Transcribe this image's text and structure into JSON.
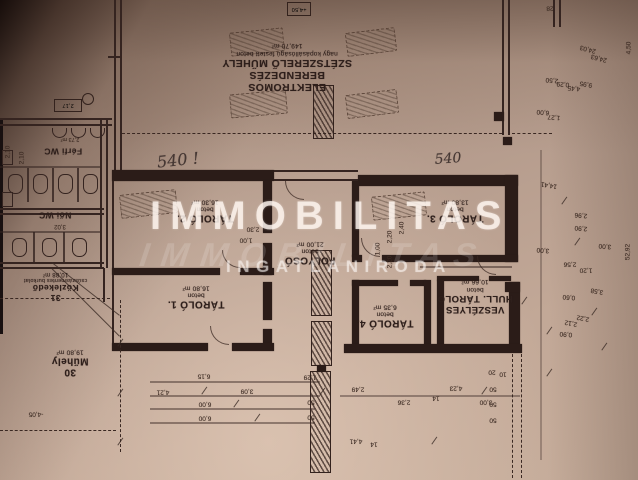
{
  "watermark": {
    "line1": "IMMOBILITAS",
    "line2": "IMMOBILITAS",
    "line3": "INGATLANIRODA"
  },
  "rooms": [
    {
      "name": "ELEKTROMOS BERENDEZÉS",
      "name2": "SZÉTSZERELŐ MŰHELY",
      "material": "nagy kopásállóságú festett beton",
      "area": "149,70 m²"
    },
    {
      "name": "TÁROLÓ 2.",
      "material": "beton",
      "area": "16,30 m²"
    },
    {
      "name": "TÁROLÓ 3.",
      "material": "beton",
      "area": "13,80 m²"
    },
    {
      "name": "FOLYOSÓ",
      "material": "beton",
      "area": "21,00 m²"
    },
    {
      "name": "TÁROLÓ 1.",
      "material": "beton",
      "area": "16,80 m²"
    },
    {
      "name": "TÁROLÓ 4.",
      "material": "beton",
      "area": "6,35 m²"
    },
    {
      "name": "VESZÉLYES",
      "name2": "HULL. TÁROLÓ",
      "material": "beton",
      "area": "10,66 m²"
    },
    {
      "name": "Férfi WC"
    },
    {
      "name": "Női WC"
    },
    {
      "num": "31",
      "name": "Közlekedő",
      "material": "csúszásmentes burkolat",
      "area": "10,88 m²"
    },
    {
      "num": "30",
      "name": "Műhely",
      "area": "19,80 m²"
    }
  ],
  "markers": {
    "level_box": "+4,50",
    "section_box": "2,17",
    "small_mark": "8,8"
  },
  "handwritten": [
    {
      "t": "540 !",
      "x": 178,
      "y": 160,
      "r": -6,
      "fs": 16
    },
    {
      "t": "540",
      "x": 448,
      "y": 159,
      "r": -4,
      "fs": 14
    }
  ],
  "dimensions": [
    {
      "t": "6,15",
      "x": 204,
      "y": 376
    },
    {
      "t": "4,21",
      "x": 163,
      "y": 392
    },
    {
      "t": "3,09",
      "x": 247,
      "y": 391
    },
    {
      "t": "6,00",
      "x": 205,
      "y": 404
    },
    {
      "t": "6,00",
      "x": 205,
      "y": 418
    },
    {
      "t": "1,29",
      "x": 310,
      "y": 377
    },
    {
      "t": "50",
      "x": 311,
      "y": 402
    },
    {
      "t": "50",
      "x": 311,
      "y": 417
    },
    {
      "t": "2,49",
      "x": 358,
      "y": 389
    },
    {
      "t": "2,36",
      "x": 404,
      "y": 402
    },
    {
      "t": "14",
      "x": 436,
      "y": 398
    },
    {
      "t": "3,00",
      "x": 486,
      "y": 402
    },
    {
      "t": "4,23",
      "x": 456,
      "y": 388
    },
    {
      "t": "4,41",
      "x": 356,
      "y": 441
    },
    {
      "t": "14",
      "x": 374,
      "y": 444
    },
    {
      "t": "-4,05",
      "x": 36,
      "y": 414
    },
    {
      "t": "2,30",
      "x": 253,
      "y": 229
    },
    {
      "t": "1,00",
      "x": 246,
      "y": 240
    },
    {
      "t": "2,20",
      "x": 390,
      "y": 237,
      "r": 270
    },
    {
      "t": "2,20",
      "x": 390,
      "y": 262,
      "r": 270
    },
    {
      "t": "1,00",
      "x": 378,
      "y": 249,
      "r": 270
    },
    {
      "t": "2,40",
      "x": 402,
      "y": 228,
      "r": 270
    },
    {
      "t": "2,10",
      "x": 8,
      "y": 152,
      "r": 270
    },
    {
      "t": "2,10",
      "x": 22,
      "y": 158,
      "r": 270
    },
    {
      "t": "2,73 m²",
      "x": 70,
      "y": 139,
      "fs": 5.5
    },
    {
      "t": "3,02",
      "x": 60,
      "y": 226,
      "fs": 6
    },
    {
      "t": "2,56",
      "x": 570,
      "y": 264
    },
    {
      "t": "1,20",
      "x": 586,
      "y": 270
    },
    {
      "t": "24,03",
      "x": 588,
      "y": 49,
      "r": 195
    },
    {
      "t": "24,63",
      "x": 599,
      "y": 58,
      "r": 195
    },
    {
      "t": "2,50",
      "x": 552,
      "y": 80,
      "r": 185
    },
    {
      "t": "0,29",
      "x": 563,
      "y": 84,
      "r": 185
    },
    {
      "t": "4,45",
      "x": 574,
      "y": 88,
      "r": 185
    },
    {
      "t": "9,95",
      "x": 586,
      "y": 84,
      "r": 190
    },
    {
      "t": "6,00",
      "x": 543,
      "y": 112,
      "r": 185
    },
    {
      "t": "1,27",
      "x": 554,
      "y": 117,
      "r": 185
    },
    {
      "t": "28",
      "x": 550,
      "y": 8
    },
    {
      "t": "4,50",
      "x": 629,
      "y": 48,
      "r": 270
    },
    {
      "t": "14,41",
      "x": 549,
      "y": 185,
      "r": 190
    },
    {
      "t": "2,96",
      "x": 581,
      "y": 215,
      "r": 185
    },
    {
      "t": "2,90",
      "x": 581,
      "y": 228,
      "r": 185
    },
    {
      "t": "3,00",
      "x": 605,
      "y": 246,
      "r": 185
    },
    {
      "t": "3,00",
      "x": 543,
      "y": 250,
      "r": 185
    },
    {
      "t": "0,60",
      "x": 569,
      "y": 297,
      "r": 185
    },
    {
      "t": "3,58",
      "x": 597,
      "y": 291,
      "r": 190
    },
    {
      "t": "2,22",
      "x": 583,
      "y": 318,
      "r": 190
    },
    {
      "t": "2,12",
      "x": 571,
      "y": 323,
      "r": 190
    },
    {
      "t": "0,90",
      "x": 566,
      "y": 334,
      "r": 185
    },
    {
      "t": "52,92",
      "x": 628,
      "y": 252,
      "r": 270
    },
    {
      "t": "20",
      "x": 492,
      "y": 372
    },
    {
      "t": "10",
      "x": 503,
      "y": 374
    },
    {
      "t": "50",
      "x": 493,
      "y": 389
    },
    {
      "t": "50",
      "x": 493,
      "y": 404
    },
    {
      "t": "50",
      "x": 493,
      "y": 420
    }
  ]
}
